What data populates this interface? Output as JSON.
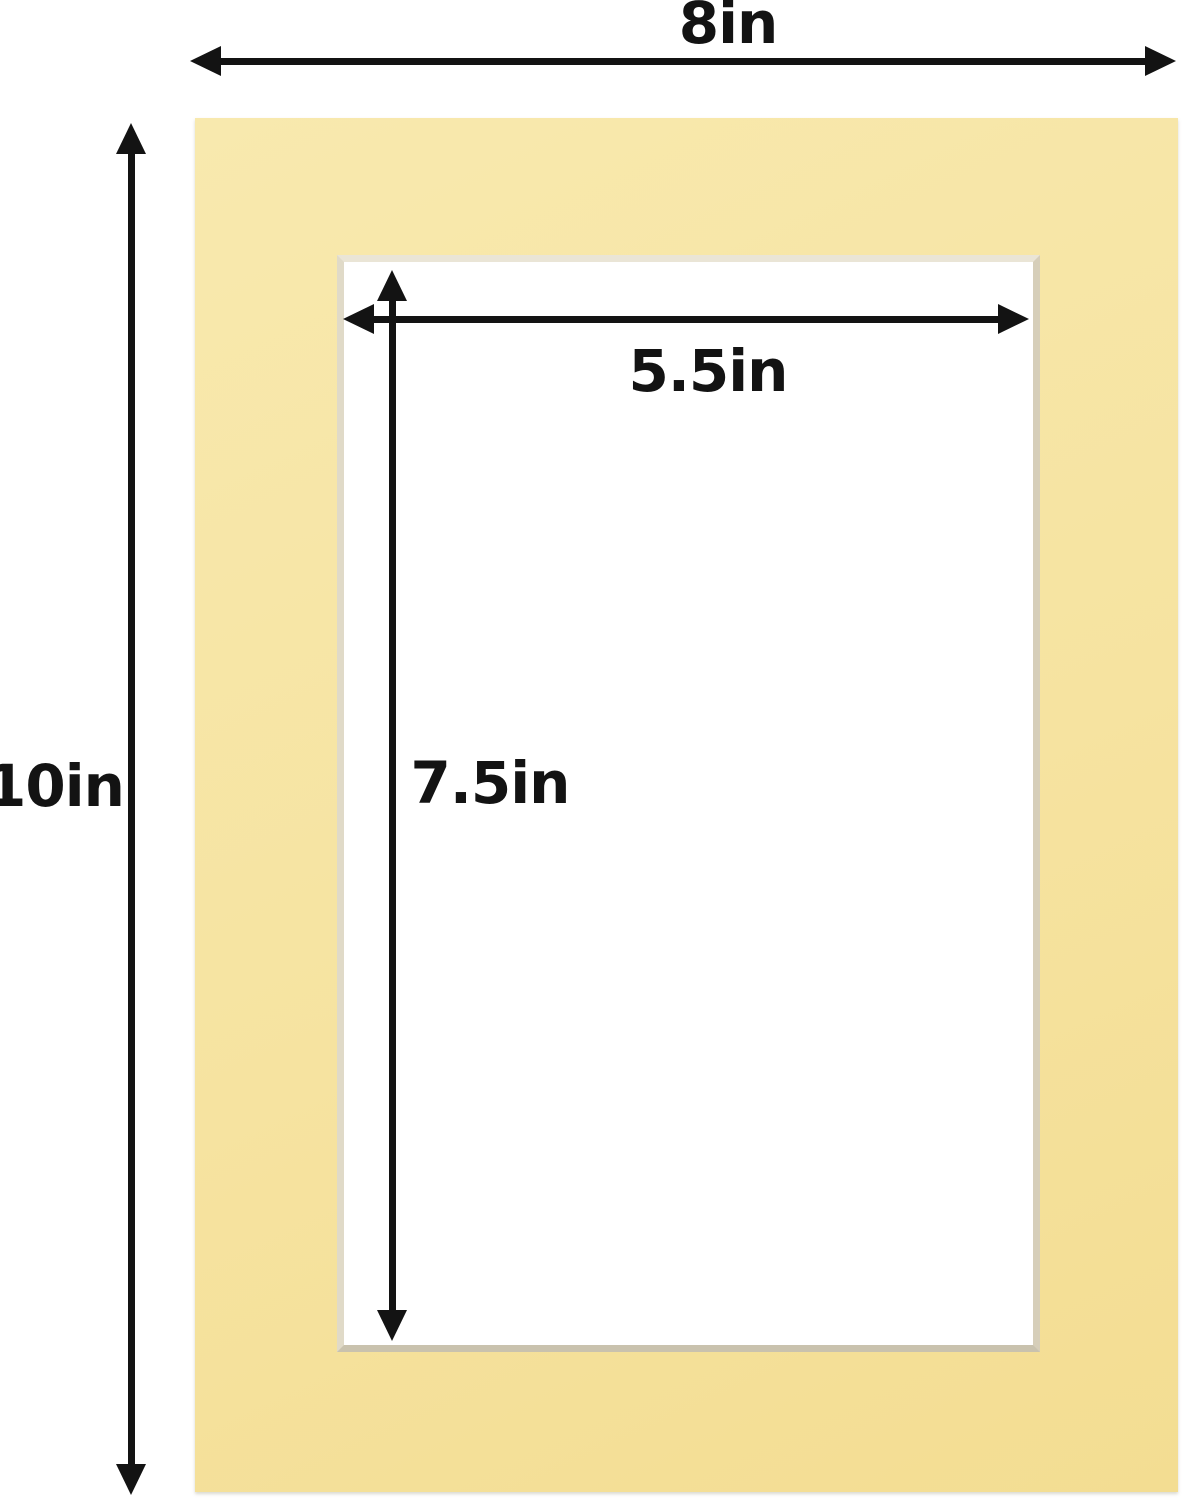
{
  "diagram": {
    "labels": {
      "outer_width": "8in",
      "outer_height": "10in",
      "opening_width": "5.5in",
      "opening_height": "7.5in"
    },
    "colors": {
      "mat_board": "#f6e3a0",
      "mat_bevel": "#d6ceb9",
      "arrow_and_text": "#131313",
      "opening_fill": "#ffffff",
      "background": "#ffffff"
    }
  }
}
